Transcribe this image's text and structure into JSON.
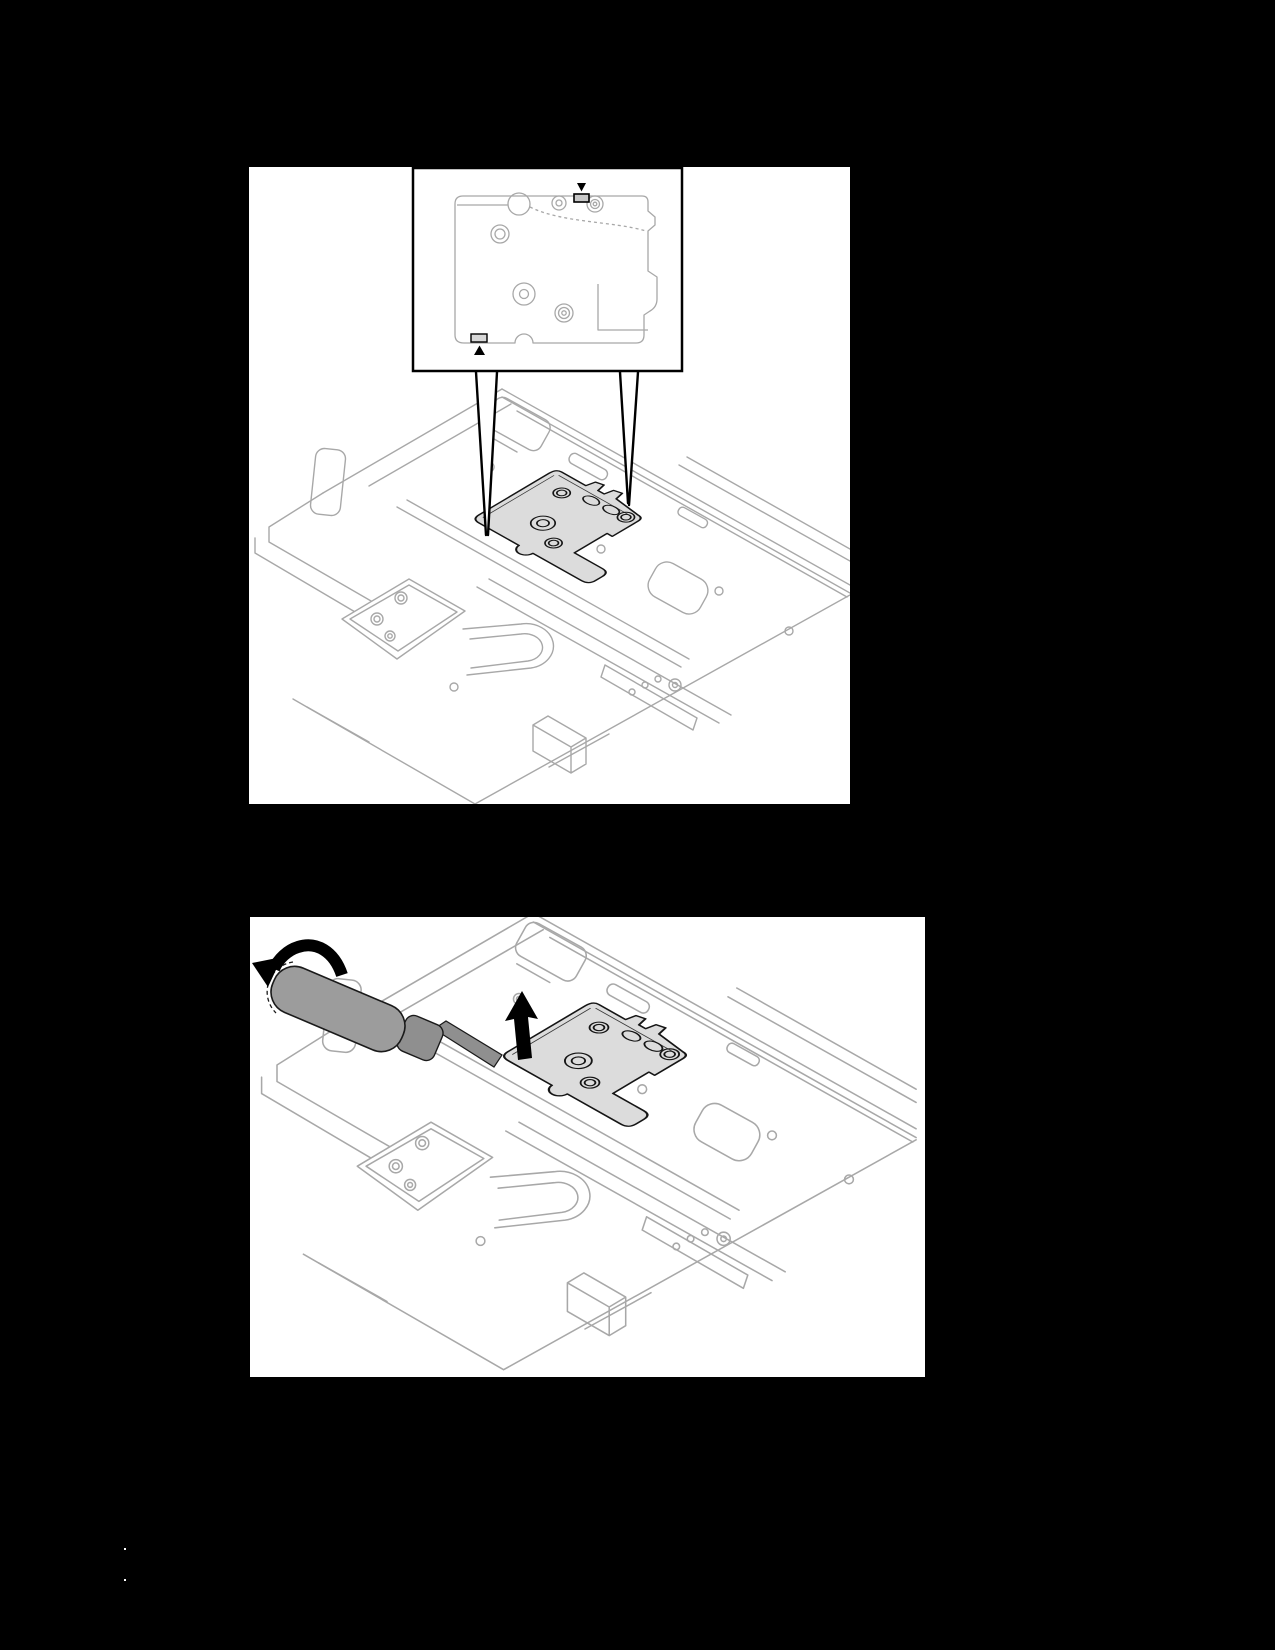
{
  "page": {
    "width": 1275,
    "height": 1650,
    "background": "#000000"
  },
  "colors": {
    "page_bg": "#000000",
    "panel_bg": "#ffffff",
    "line_art": "#a8a8a8",
    "outline_dark": "#151515",
    "plate_fill": "#dcdcdc",
    "tool_fill": "#9c9c9c",
    "tool_fill_dark": "#8f8f8f",
    "pad_fill": "#c8c8c8",
    "pad_fill_light": "#d8d8d8",
    "marker": "#000000"
  },
  "figures": [
    {
      "id": "figure-top",
      "aria": "Line drawing of a node tray with a cold plate; a detail callout box shows the flat plate with two highlighted pad strips marked by black triangles, connected by leader lines to the plate in the tray",
      "icons": [
        "triangle-down-marker",
        "triangle-up-marker"
      ],
      "parts": [
        "callout-detail-box",
        "pad-strip-top",
        "pad-strip-bottom",
        "leader-left",
        "leader-right",
        "target-cold-plate",
        "node-tray-line-art"
      ]
    },
    {
      "id": "figure-bottom",
      "aria": "Line drawing of the same node tray; a gray screwdriver with a curved rotation arrow pries under the cold plate corner while a black arrow points up from the plate",
      "icons": [
        "rotate-counterclockwise-arrow",
        "lift-up-arrow"
      ],
      "parts": [
        "screwdriver",
        "target-cold-plate",
        "node-tray-line-art"
      ]
    }
  ],
  "artifacts": {
    "dots": [
      {
        "x": 124,
        "y": 1548
      },
      {
        "x": 124,
        "y": 1579
      }
    ]
  }
}
